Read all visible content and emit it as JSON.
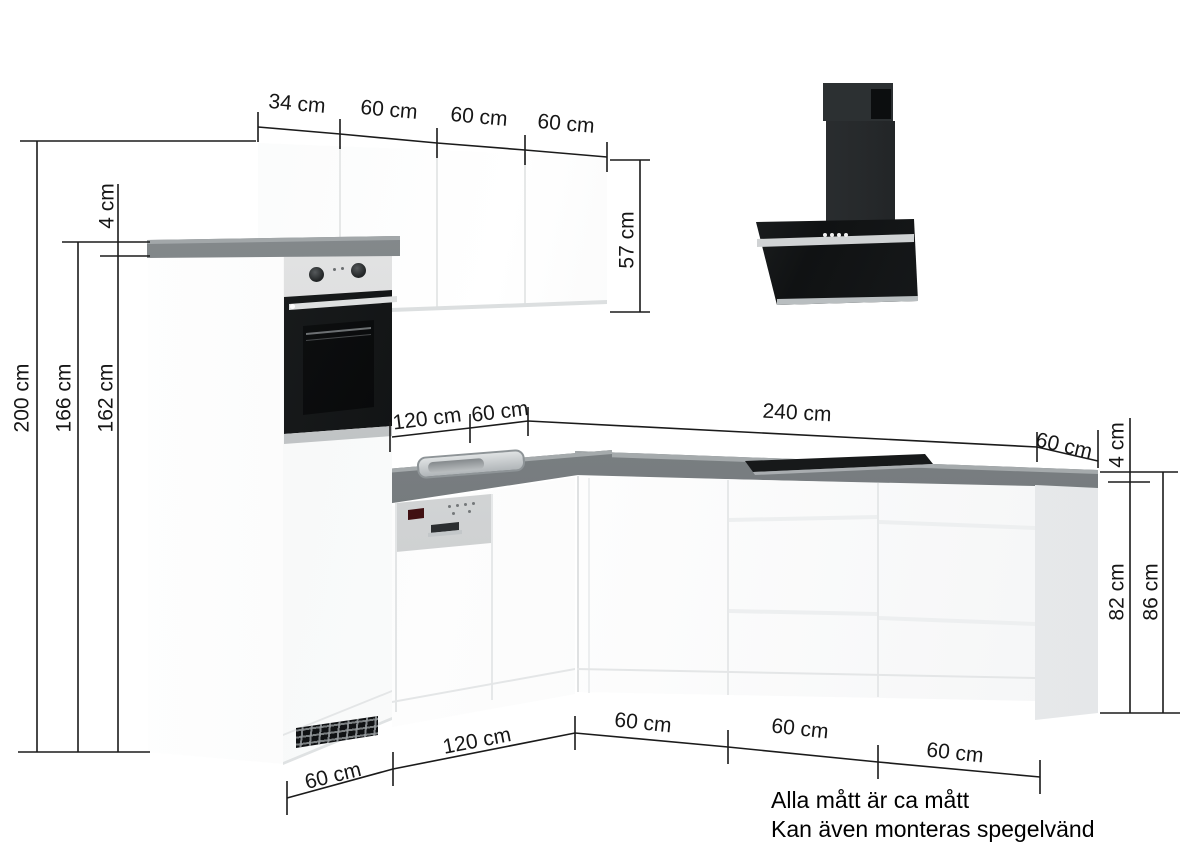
{
  "dimensions": {
    "upper_widths": [
      "34 cm",
      "60 cm",
      "60 cm",
      "60 cm"
    ],
    "upper_cabinet_height": "57 cm",
    "left_heights": {
      "total": "200 cm",
      "to_worktop_top": "166 cm",
      "to_worktop_bottom": "162 cm",
      "worktop_thickness": "4 cm"
    },
    "worktop_runs": {
      "left_run": "120 cm",
      "corner": "60 cm",
      "right_run": "240 cm"
    },
    "right_side": {
      "end_width": "60 cm",
      "worktop_thickness": "4 cm",
      "cabinet_height": "82 cm",
      "total_height": "86 cm"
    },
    "base_widths_left": [
      "60 cm",
      "120 cm"
    ],
    "base_widths_right": [
      "60 cm",
      "60 cm",
      "60 cm"
    ]
  },
  "notes": [
    "Alla mått är ca mått",
    "Kan även monteras spegelvänd"
  ],
  "colors": {
    "worktop": "#7f8487",
    "cabinet_white": "#fafbfb",
    "hood_black": "#17191b",
    "stainless": "#c8cacb",
    "dimension_line": "#1b1b1b"
  }
}
